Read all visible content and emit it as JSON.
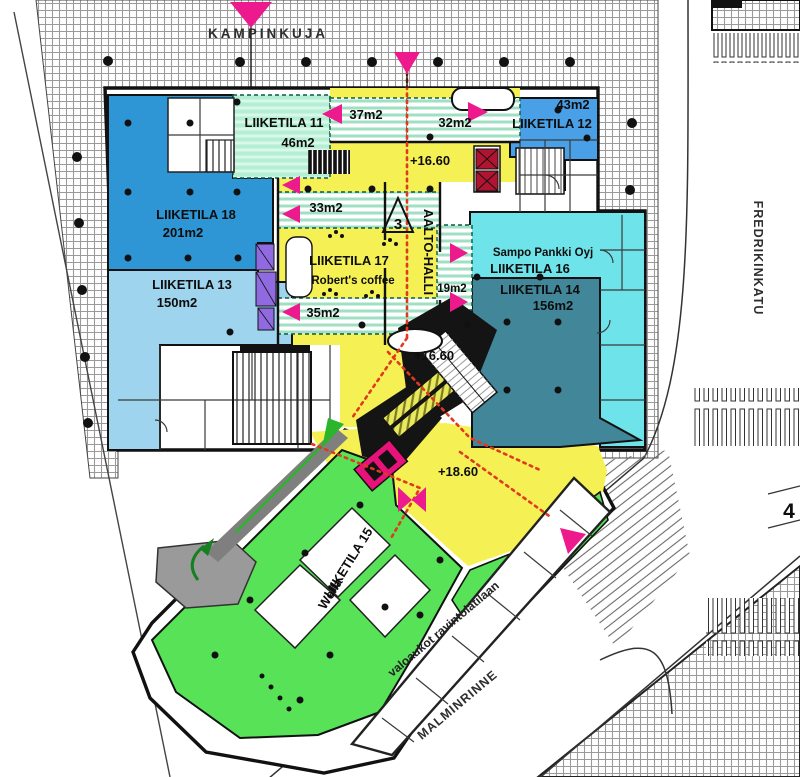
{
  "plan": {
    "streets": {
      "top": "KAMPINKUJA",
      "right": "FREDRIKINKATU",
      "bottom": "MALMINRINNE"
    },
    "hall": {
      "name": "AALTO-HALLI",
      "section_marker": "3"
    },
    "levels": {
      "upper": "+16.60",
      "mid": "+16.60",
      "lower": "+18.60"
    },
    "note_skylights": "valoaukot ravintolatilaan",
    "edge_marker": "4",
    "rooms": [
      {
        "key": "liiketila-18",
        "name": "LIIKETILA 18",
        "detail": "201m2",
        "color": "#2f96d6"
      },
      {
        "key": "liiketila-13",
        "name": "LIIKETILA 13",
        "detail": "150m2",
        "color": "#9fd4ee"
      },
      {
        "key": "liiketila-11",
        "name": "LIIKETILA 11",
        "detail": "46m2",
        "color": "#aeeccf"
      },
      {
        "key": "liiketila-12",
        "name": "LIIKETILA 12",
        "detail": "43m2",
        "color": "#4aa0e6"
      },
      {
        "key": "liiketila-16",
        "name": "LIIKETILA 16",
        "detail": "Sampo Pankki Oyj",
        "color": "#6fe3ea"
      },
      {
        "key": "liiketila-14",
        "name": "LIIKETILA 14",
        "detail": "156m2",
        "color": "#42869a"
      },
      {
        "key": "liiketila-17",
        "name": "LIIKETILA 17",
        "detail": "Robert's coffee",
        "color": "#f5f155"
      },
      {
        "key": "liiketila-15",
        "name": "LIIKETILA 15",
        "detail": "Wella",
        "color": "#57e257"
      }
    ],
    "shaft_areas": [
      "37m2",
      "32m2",
      "33m2",
      "35m2",
      "19m2"
    ],
    "colors": {
      "hall_yellow": "#f5f155",
      "route_red": "#e03a1e",
      "entrance_pink": "#ec1a8c",
      "elevator_purple": "#8f6ae0",
      "escalator_crimson": "#e8127a",
      "ramp_gray": "#8a8a8a"
    }
  }
}
